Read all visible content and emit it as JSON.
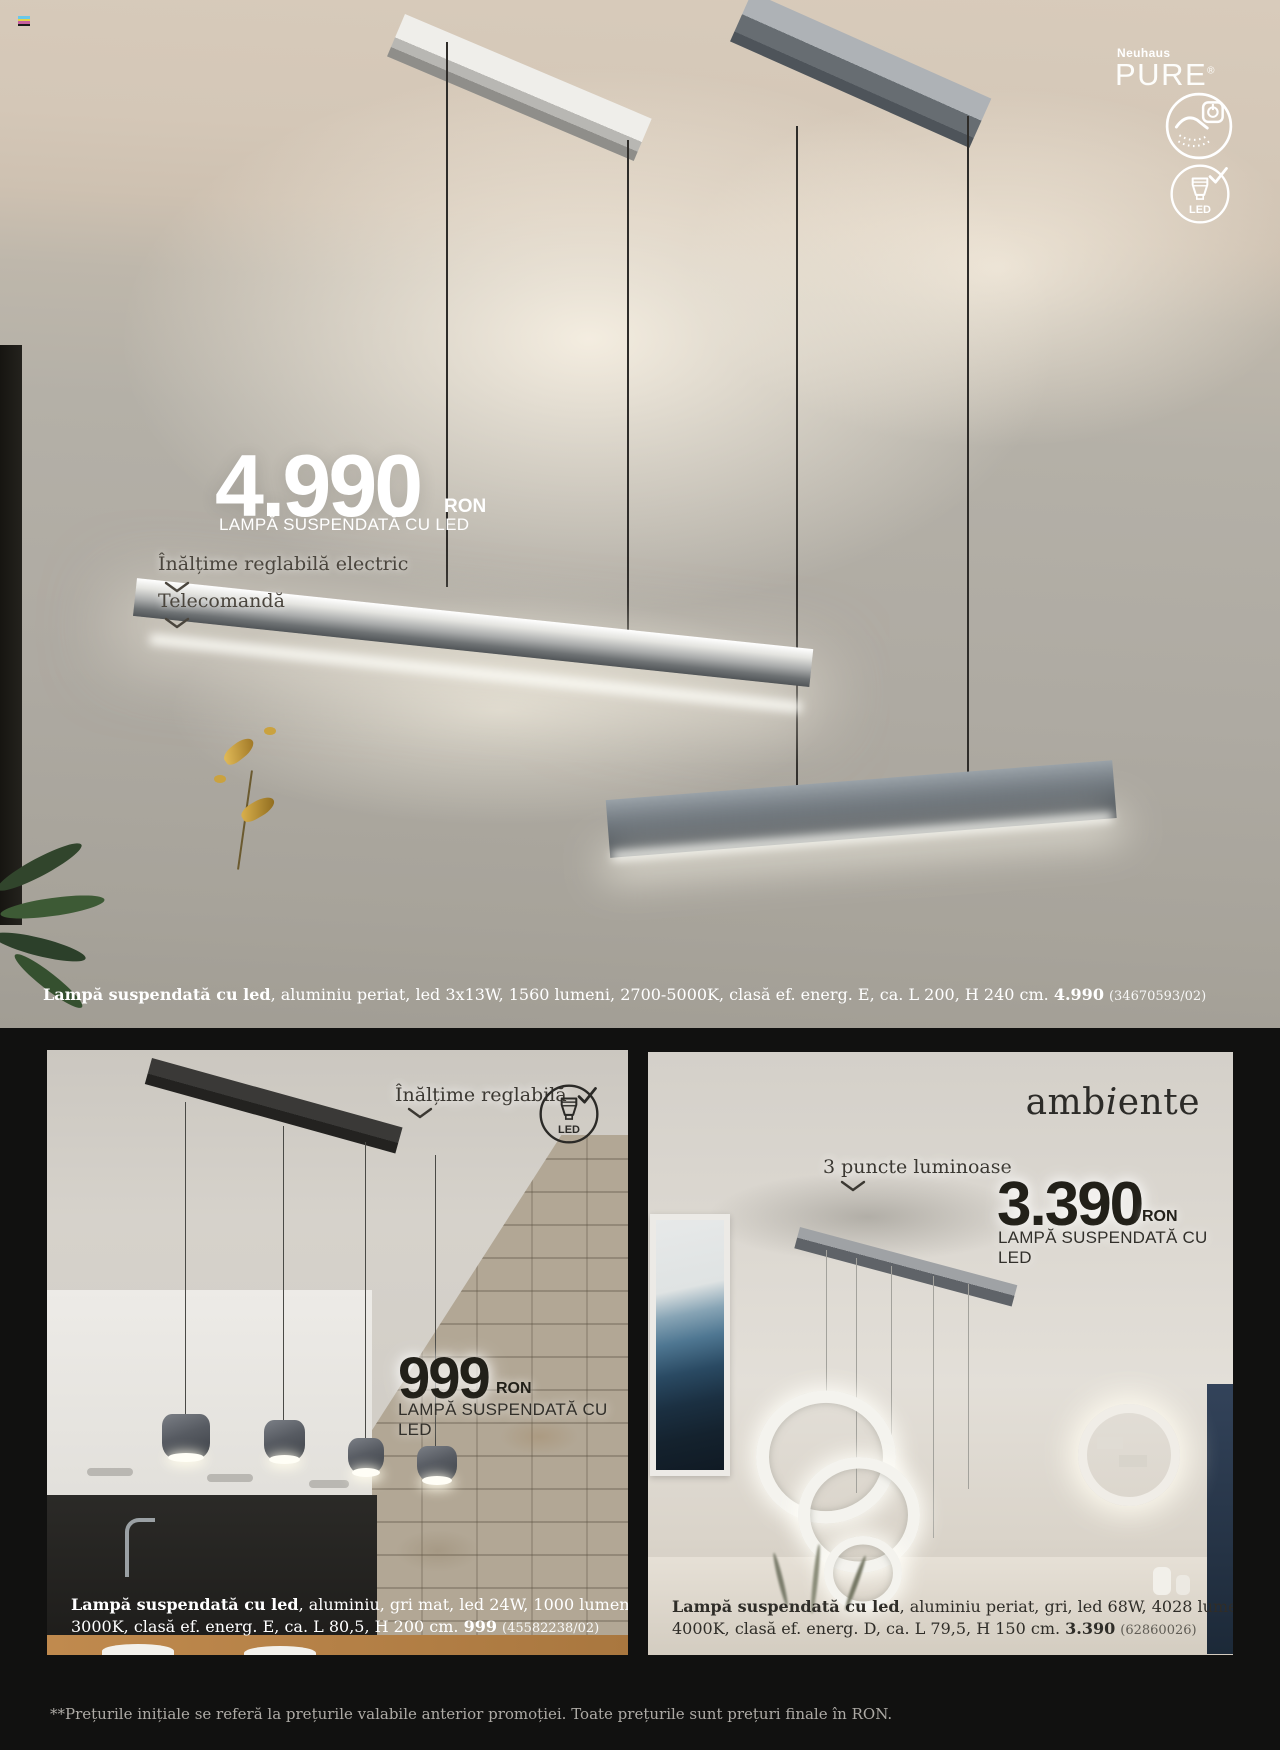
{
  "page": {
    "footnote": "**Prețurile inițiale se referă la prețurile valabile anterior promoției. Toate prețurile sunt prețuri finale în RON."
  },
  "hero": {
    "brand": {
      "maker": "Neuhaus",
      "line": "PURE",
      "mark": "®"
    },
    "badges": {
      "led_label": "LED"
    },
    "price": {
      "amount": "4.990",
      "currency": "RON"
    },
    "product_type": "LAMPĂ SUSPENDATĂ CU LED",
    "features": [
      {
        "label": "Înălțime reglabilă electric"
      },
      {
        "label": "Telecomandă"
      }
    ],
    "caption": {
      "bold": "Lampă suspendată cu led",
      "details": ", aluminiu periat, led 3x13W, 1560 lumeni, 2700-5000K, clasă ef. energ. E, ca. L 200, H 240 cm. ",
      "price": "4.990",
      "sku": "(34670593/02)"
    }
  },
  "card_small": {
    "feature": "Înălțime reglabilă",
    "led_label": "LED",
    "price": {
      "amount": "999",
      "currency": "RON"
    },
    "product_type": "LAMPĂ SUSPENDATĂ CU LED",
    "caption": {
      "bold": "Lampă suspendată cu led",
      "details_line1": ", aluminiu, gri mat, led 24W, 1000 lumeni,",
      "details_line2": "3000K, clasă ef. energ. E, ca. L 80,5, H 200 cm. ",
      "price": "999",
      "sku": "(45582238/02)"
    }
  },
  "card_ambiente": {
    "brand": {
      "part1": "amb",
      "part2": "i",
      "part3": "ente"
    },
    "feature": "3 puncte luminoase",
    "price": {
      "amount": "3.390",
      "currency": "RON"
    },
    "product_type": "LAMPĂ SUSPENDATĂ CU LED",
    "caption": {
      "bold": "Lampă suspendată cu led",
      "details_line1": ", aluminiu periat, gri, led 68W, 4028 lumeni,",
      "details_line2": "4000K, clasă ef. energ. D, ca. L 79,5, H 150 cm. ",
      "price": "3.390",
      "sku": "(62860026)"
    }
  }
}
